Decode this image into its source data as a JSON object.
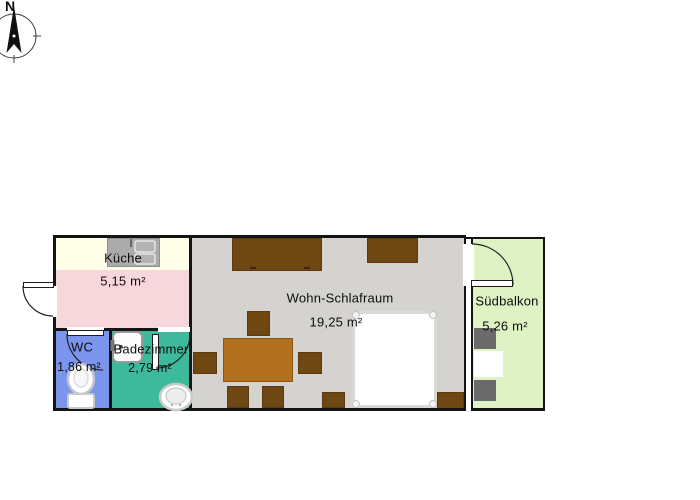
{
  "compass": {
    "north": "N"
  },
  "rooms": {
    "kueche": {
      "name": "Küche",
      "area": "5,15 m²"
    },
    "wc": {
      "name": "WC",
      "area": "1,86 m²"
    },
    "badezimmer": {
      "name": "Badezimmer",
      "area": "2,79 m²"
    },
    "wohnschlafraum": {
      "name": "Wohn-Schlafraum",
      "area": "19,25 m²"
    },
    "suedbalkon": {
      "name": "Südbalkon",
      "area": "5,26 m²"
    }
  },
  "colors": {
    "kueche": "#F8D7DC",
    "kueche_counter_zone": "#FEFFE6",
    "kitchen_counter": "#ABABAB",
    "wc": "#7B95ED",
    "badezimmer": "#3DBA9C",
    "wohnschlafraum": "#D5D3D0",
    "suedbalkon": "#DFF2C4",
    "furniture_dark_wood": "#6F4713",
    "dining_table": "#B0701E",
    "balcony_furniture": "#6A6A6A",
    "walls": "#141414"
  },
  "furniture": {
    "kueche": [
      "kitchen-counter",
      "kitchen-sink"
    ],
    "wc": [
      "toilet"
    ],
    "badezimmer": [
      "shower",
      "washbasin"
    ],
    "wohnschlafraum": [
      "wardrobe",
      "cabinet",
      "dining-table",
      "chairs",
      "bed",
      "sideboard"
    ],
    "suedbalkon": [
      "balcony-chair",
      "balcony-table",
      "balcony-chair"
    ]
  }
}
